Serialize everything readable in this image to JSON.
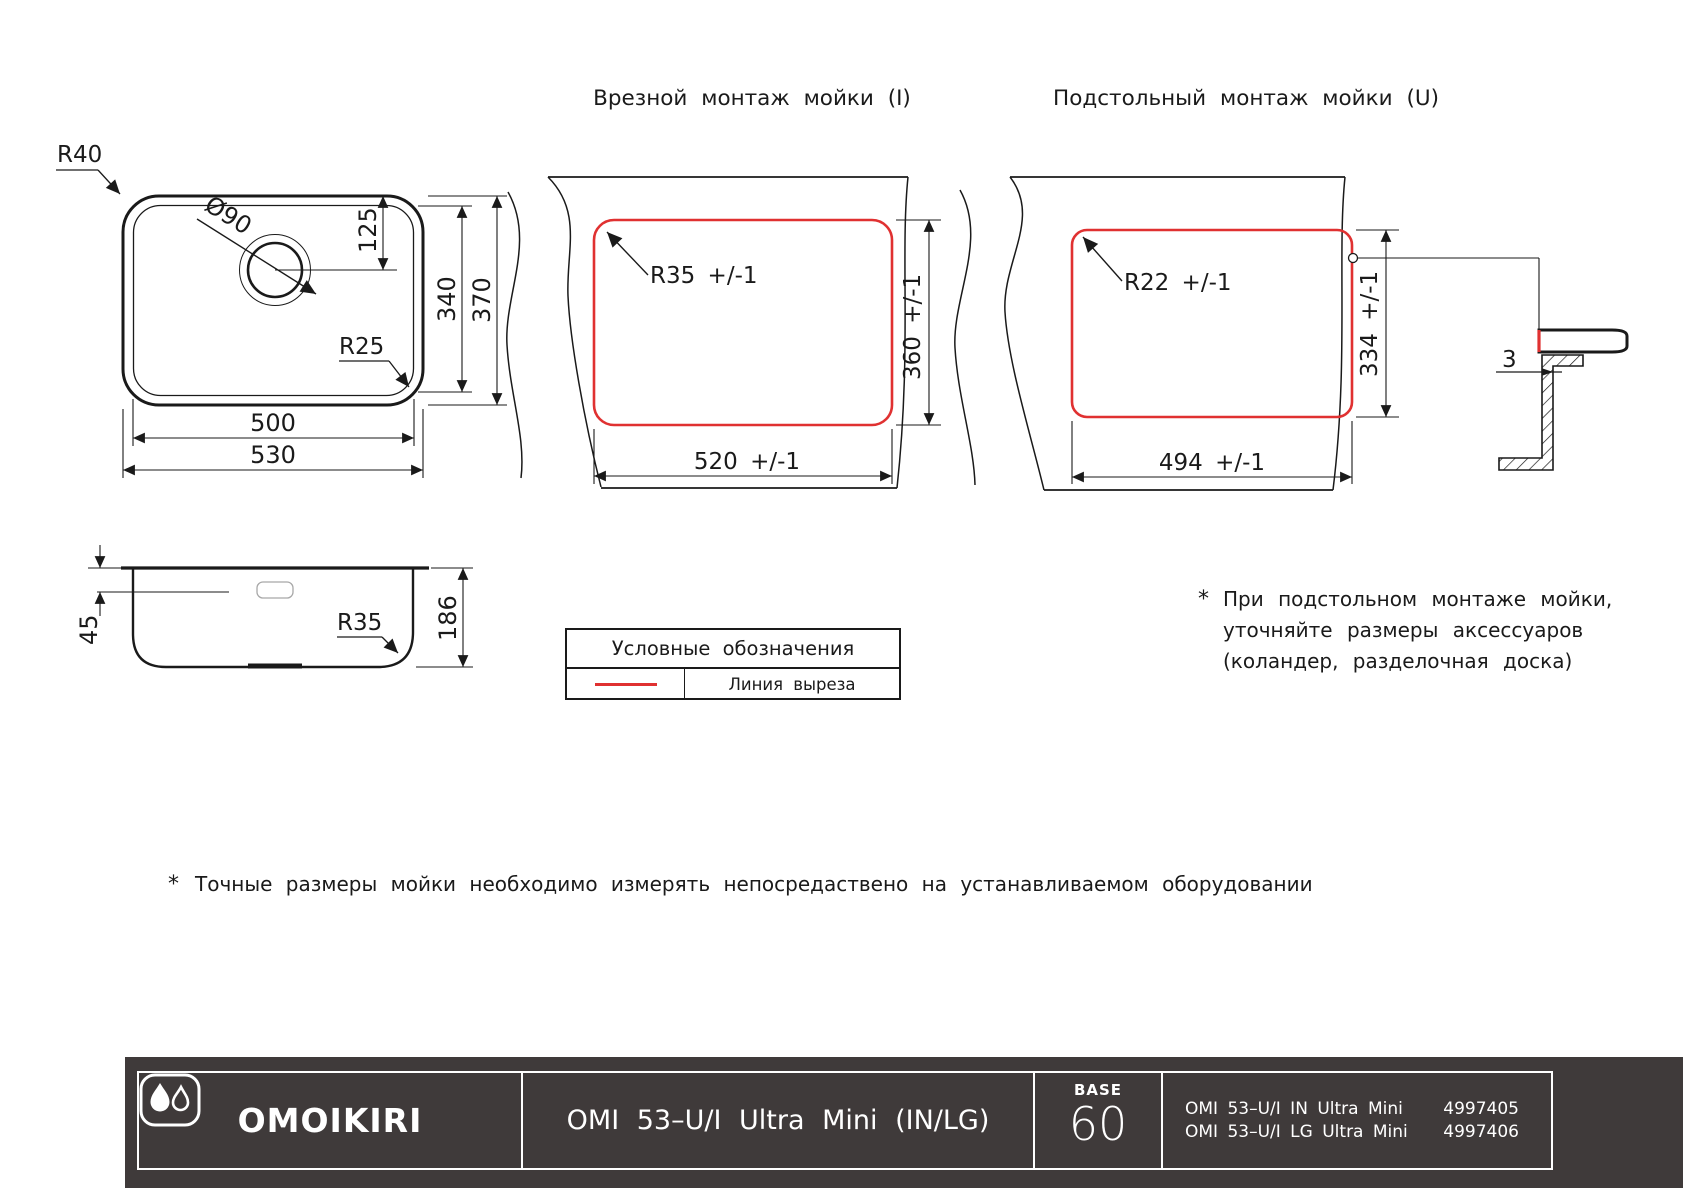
{
  "top_view": {
    "r40": "R40",
    "d90": "Ø90",
    "d125": "125",
    "d340": "340",
    "d370": "370",
    "r25": "R25",
    "d500": "500",
    "d530": "530"
  },
  "inset": {
    "title": "Врезной монтаж мойки (I)",
    "radius": "R35 +/-1",
    "height": "360 +/-1",
    "width": "520 +/-1"
  },
  "under": {
    "title": "Подстольный монтаж мойки (U)",
    "radius": "R22 +/-1",
    "height": "334 +/-1",
    "width": "494 +/-1",
    "gap": "3"
  },
  "side": {
    "d45": "45",
    "d186": "186",
    "r35": "R35"
  },
  "legend": {
    "title": "Условные обозначения",
    "cut_line": "Линия выреза"
  },
  "notes": {
    "star": "*",
    "under_lines": [
      "При подстольном монтаже мойки,",
      "уточняйте размеры аксессуаров",
      "(коландер, разделочная доска)"
    ],
    "bottom": "Точные размеры мойки необходимо измерять непосредаствено на устанавливаемом оборудовании"
  },
  "footer": {
    "brand": "OMOIKIRI",
    "model": "OMI 53–U/I Ultra Mini (IN/LG)",
    "base_label": "BASE",
    "base_value": "60",
    "variants": [
      {
        "name": "OMI 53–U/I IN Ultra Mini",
        "code": "4997405"
      },
      {
        "name": "OMI 53–U/I LG Ultra Mini",
        "code": "4997406"
      }
    ]
  },
  "colors": {
    "cut_line": "#e03131",
    "line": "#1a1a1a",
    "footer_bg": "#3f3a3a"
  }
}
